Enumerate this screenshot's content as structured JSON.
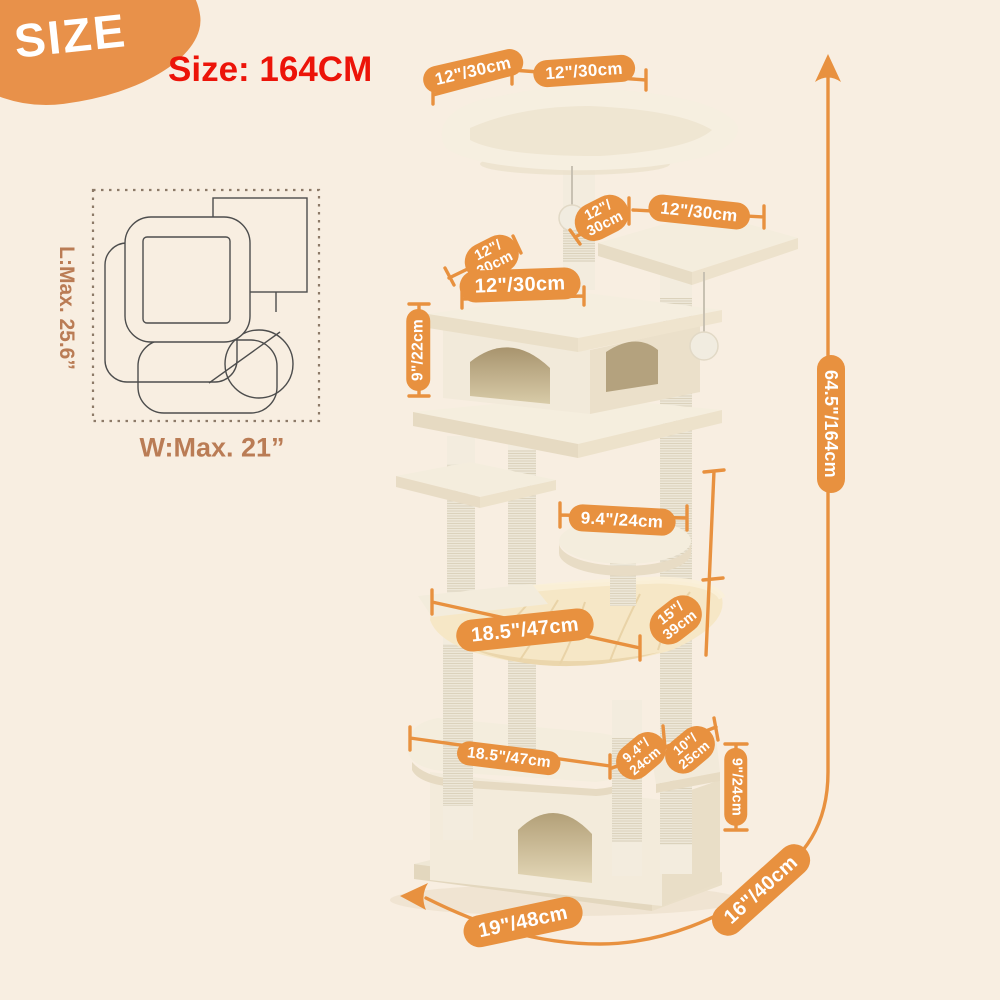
{
  "badge": {
    "label": "SIZE"
  },
  "title": "Size: 164CM",
  "bed_diagram": {
    "length_label": "L:Max. 25.6”",
    "width_label": "W:Max. 21”"
  },
  "dims": {
    "top_perch_left": "12\"/30cm",
    "top_perch_right": "12\"/30cm",
    "tier2_post": {
      "lines": [
        "12\"/",
        "30cm"
      ]
    },
    "tier2_platform": "12\"/30cm",
    "house_depth": {
      "lines": [
        "12\"/",
        "30cm"
      ]
    },
    "house_width": "12\"/30cm",
    "house_height": "9\"/22cm",
    "round_platform": "9.4\"/24cm",
    "hammock_width": "18.5\"/47cm",
    "hammock_depth": {
      "lines": [
        "15\"/",
        "39cm"
      ]
    },
    "lower_platform_width": "18.5\"/47cm",
    "lower_platform_depth": {
      "lines": [
        "9.4\"/",
        "24cm"
      ]
    },
    "side_platform": {
      "lines": [
        "10\"/",
        "25cm"
      ]
    },
    "condo_height": "9\"/24cm",
    "base_width": "19\"/48cm",
    "base_depth": "16\"/40cm",
    "total_height": "64.5\"/164cm"
  },
  "colors": {
    "accent_orange": "#E8913F",
    "title_red": "#EC1409",
    "diagram_brown": "#BA7C55",
    "background": "#F8EEE1",
    "tree_plush": "#F4EDDD",
    "hammock_fabric": "#F5E5C3"
  }
}
